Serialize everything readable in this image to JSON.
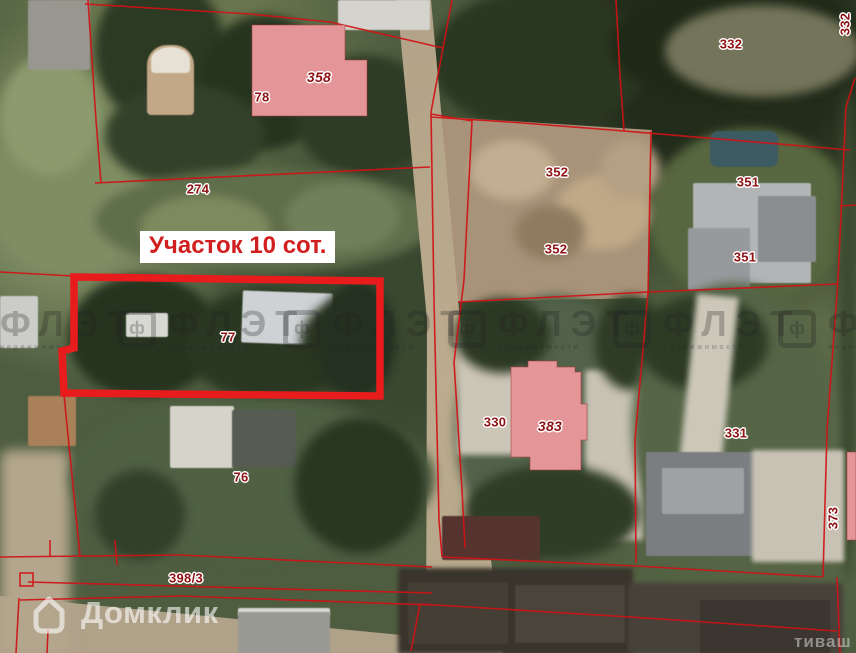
{
  "map": {
    "plot_callout": "Участок 10 сот.",
    "parcel_labels": [
      {
        "text": "358"
      },
      {
        "text": "78"
      },
      {
        "text": "274"
      },
      {
        "text": "77"
      },
      {
        "text": "76"
      },
      {
        "text": "352"
      },
      {
        "text": "352"
      },
      {
        "text": "351"
      },
      {
        "text": "351"
      },
      {
        "text": "332"
      },
      {
        "text": "332"
      },
      {
        "text": "330"
      },
      {
        "text": "383"
      },
      {
        "text": "331"
      },
      {
        "text": "373"
      },
      {
        "text": "398/3"
      }
    ],
    "colors": {
      "boundary_line": "#d01216",
      "plot_outline": "#e81c1c",
      "building_fill": "#e49598",
      "label_text": "#8e1214",
      "callout_text": "#d11f1f",
      "callout_bg": "#ffffff"
    }
  },
  "watermarks": {
    "domclick": "Домклик",
    "flat_brand": "ФЛЭТ",
    "flat_icon_letter": "ф",
    "flat_subtitle": "недвижимости",
    "corner_fragment": "тиваш"
  }
}
